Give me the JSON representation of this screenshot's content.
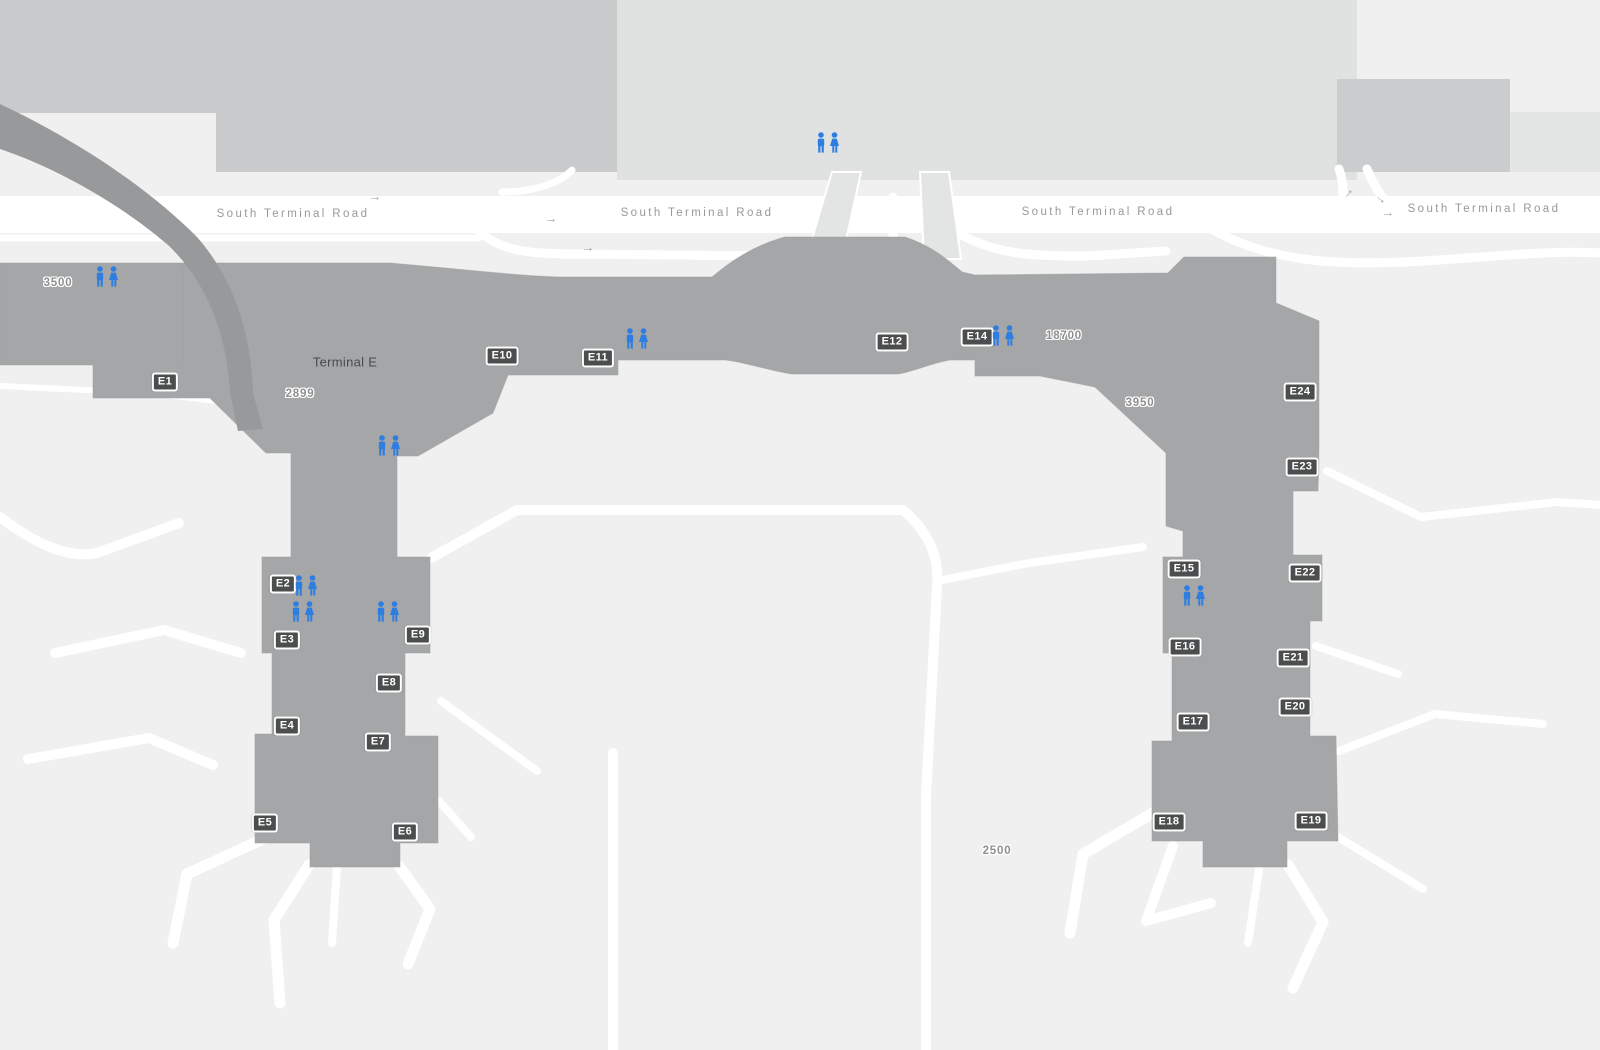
{
  "map": {
    "terminal_label": "Terminal E",
    "road_name": "South Terminal Road",
    "terminal_label_pos": {
      "x": 345,
      "y": 362
    },
    "road_label_positions": [
      {
        "x": 293,
        "y": 214
      },
      {
        "x": 697,
        "y": 213
      },
      {
        "x": 1098,
        "y": 212
      },
      {
        "x": 1484,
        "y": 209
      }
    ],
    "gates": [
      {
        "label": "E1",
        "x": 165,
        "y": 382
      },
      {
        "label": "E2",
        "x": 283,
        "y": 584
      },
      {
        "label": "E3",
        "x": 287,
        "y": 640
      },
      {
        "label": "E4",
        "x": 287,
        "y": 726
      },
      {
        "label": "E5",
        "x": 265,
        "y": 823
      },
      {
        "label": "E6",
        "x": 405,
        "y": 832
      },
      {
        "label": "E7",
        "x": 378,
        "y": 742
      },
      {
        "label": "E8",
        "x": 389,
        "y": 683
      },
      {
        "label": "E9",
        "x": 418,
        "y": 635
      },
      {
        "label": "E10",
        "x": 502,
        "y": 356
      },
      {
        "label": "E11",
        "x": 598,
        "y": 358
      },
      {
        "label": "E12",
        "x": 892,
        "y": 342
      },
      {
        "label": "E14",
        "x": 977,
        "y": 337
      },
      {
        "label": "E15",
        "x": 1184,
        "y": 569
      },
      {
        "label": "E16",
        "x": 1185,
        "y": 647
      },
      {
        "label": "E17",
        "x": 1193,
        "y": 722
      },
      {
        "label": "E18",
        "x": 1169,
        "y": 822
      },
      {
        "label": "E19",
        "x": 1311,
        "y": 821
      },
      {
        "label": "E20",
        "x": 1295,
        "y": 707
      },
      {
        "label": "E21",
        "x": 1293,
        "y": 658
      },
      {
        "label": "E22",
        "x": 1305,
        "y": 573
      },
      {
        "label": "E23",
        "x": 1302,
        "y": 467
      },
      {
        "label": "E24",
        "x": 1300,
        "y": 392
      }
    ],
    "area_numbers": [
      {
        "text": "3500",
        "x": 58,
        "y": 283
      },
      {
        "text": "2899",
        "x": 300,
        "y": 394
      },
      {
        "text": "18700",
        "x": 1064,
        "y": 336
      },
      {
        "text": "3950",
        "x": 1140,
        "y": 403
      },
      {
        "text": "2500",
        "x": 997,
        "y": 851
      }
    ],
    "restrooms": [
      {
        "x": 107,
        "y": 277
      },
      {
        "x": 828,
        "y": 143
      },
      {
        "x": 637,
        "y": 339
      },
      {
        "x": 1003,
        "y": 336
      },
      {
        "x": 389,
        "y": 446
      },
      {
        "x": 306,
        "y": 586
      },
      {
        "x": 303,
        "y": 612
      },
      {
        "x": 388,
        "y": 612
      },
      {
        "x": 1194,
        "y": 596
      }
    ],
    "arrows": [
      {
        "x": 375,
        "y": 196,
        "rotate": 0
      },
      {
        "x": 551,
        "y": 218,
        "rotate": 0
      },
      {
        "x": 588,
        "y": 247,
        "rotate": 0
      },
      {
        "x": 1347,
        "y": 192,
        "rotate": -50
      },
      {
        "x": 1382,
        "y": 198,
        "rotate": 40
      },
      {
        "x": 1388,
        "y": 212,
        "rotate": 0
      }
    ],
    "icons": {
      "arrow": "→",
      "restroom": "male-female-restroom"
    },
    "colors": {
      "background": "#eff0ef",
      "terminal_gray": "#a5a6a7",
      "ramp_gray": "#97999b",
      "parking_block": "#c9cacb",
      "parking_block_light": "#e0e1e1",
      "walkway_light": "#e3e4e4",
      "road_white": "#ffffff",
      "badge_bg": "#4b4d4e",
      "accent_blue": "#2e7ee2",
      "road_label_gray": "#98999b",
      "area_number_gray": "#8e8f91"
    }
  }
}
